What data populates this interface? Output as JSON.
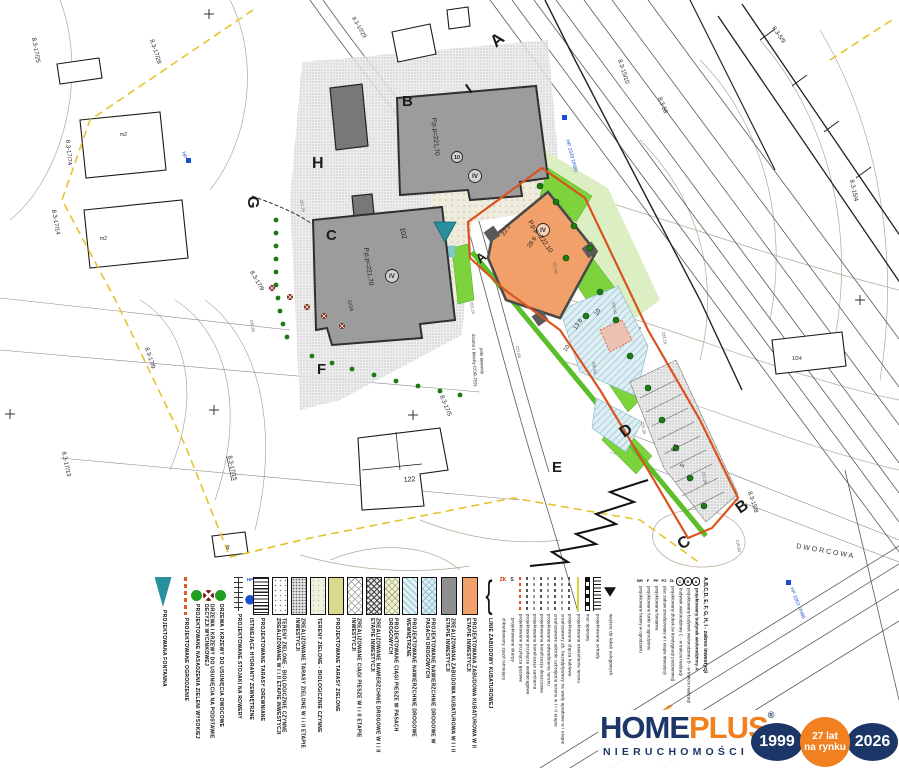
{
  "colors": {
    "boundary_yellow": "#e6c32e",
    "investment_orange": "#d9531e",
    "building_gray": "#9c9c9c",
    "building_orange": "#f0a068",
    "green_bright": "#7cd33c",
    "teal_fountain": "#2a8f9c",
    "logo_navy": "#1c3667",
    "logo_orange": "#f08020",
    "hydrant_blue": "#1b4fd0"
  },
  "legend": {
    "items": [
      {
        "symbol": "sym-fountain",
        "label": "PROJEKTOWANA FONTANNA",
        "x": 155
      },
      {
        "symbol": "sym-fence",
        "label": "PROJEKTOWANE OGRODZENIE",
        "x": 177
      },
      {
        "symbol": "sym-tree-green",
        "label": "PROJEKTOWANE NASADZENIA ZIELENI WYSOKIEJ",
        "x": 188
      },
      {
        "symbol": "sym-tree-remove",
        "label": "DRZEWA I KRZEWY DO USUNIĘCIA NA PODSTAWIE DECYZJI WYCINKOWEJ",
        "x": 200
      },
      {
        "symbol": "sym-tree-fruit",
        "label": "DRZEWA I KRZEWY DO USUNIĘCIA OWOCOWE",
        "x": 212
      },
      {
        "symbol": "sym-bike",
        "label": "PROJEKTOWANE STOJAKI NA ROWERY",
        "x": 230
      },
      {
        "symbol": "sym-hydrant",
        "label": "ISTNIEJĄCE HYDRANTY ZEWNĘTRZNE",
        "x": 242,
        "sym_text": "HP"
      },
      {
        "symbol": "sw sw-stripes",
        "label": "PROJEKTOWANE TARASY DREWNIANE",
        "x": 253
      },
      {
        "symbol": "sw sw-dots-sparse",
        "label": "TERENY ZIELONE - BIOLOGICZNIE CZYNNE ZREALIZOWANE W I i II ETAPIE INWESTYCJI",
        "x": 272
      },
      {
        "symbol": "sw sw-stipple",
        "label": "ZREALIZOWANE TARASY ZIELONE W I i II ETAPIE INWESTYCJI",
        "x": 291
      },
      {
        "symbol": "sw sw-pale-green",
        "label": "TERENY ZIELONE - BIOLOGICZNIE CZYNNE",
        "x": 310
      },
      {
        "symbol": "sw sw-yellow-green",
        "label": "PROJEKTOWANE TARASY ZIELONE",
        "x": 328
      },
      {
        "symbol": "sw sw-diamond-white",
        "label": "ZREALIZOWANE CIĄGI PIESZE W I i II ETAPIE INWESTYCJI",
        "x": 347
      },
      {
        "symbol": "sw sw-diamond-dark",
        "label": "ZREALIZOWANE NAWIERZCHNIE DROGOWE W I i II ETAPIE INWESTYCJI",
        "x": 366
      },
      {
        "symbol": "sw sw-diamond-yellow",
        "label": "PROJEKTOWANE CIĄGI PIESZE W PASACH DROGOWYCH",
        "x": 384
      },
      {
        "symbol": "sw sw-hatch-blue",
        "label": "PROJEKTOWANE NAWIERZCHNIE DROGOWE WEWNĘTRZNE",
        "x": 402
      },
      {
        "symbol": "sw sw-diamond-blue",
        "label": "PROJEKTOWANE NAWIERZCHNIE DROGOWE W PASACH DROGOWYCH",
        "x": 421
      },
      {
        "symbol": "sw sw-gray",
        "label": "ZREALIZOWANA ZABUDOWA KUBATUROWA W I i II ETAPIE INWESTYCJI",
        "x": 441
      },
      {
        "symbol": "sw sw-orange",
        "label": "PROJEKTOWANA ZABUDOWA KUBATUROWA W II ETAPIE INWESTYCJI",
        "x": 462
      },
      {
        "symbol": "sym-bracket",
        "label": "LINIE ZABUDOWY KUBATUROWEJ",
        "x": 481,
        "sym_text": "{",
        "bold": true
      },
      {
        "symbol": "sym-text red",
        "label": "zlikwidowany zjazd istniejący",
        "x": 497,
        "sym_text": "ZK",
        "small": true
      },
      {
        "symbol": "sym-text",
        "label": "projektowane skarpy",
        "x": 506,
        "sym_text": "S",
        "small": true
      },
      {
        "symbol": "sym-dash c-orange",
        "label": "projektowane przyłącza gazowe",
        "x": 514,
        "small": true
      },
      {
        "symbol": "sym-dash",
        "label": "projektowane przyłącze wodociągowe",
        "x": 521,
        "small": true
      },
      {
        "symbol": "sym-dash c-gray",
        "label": "projektowana kanalizacja sanitarna",
        "x": 528,
        "small": true
      },
      {
        "symbol": "sym-dash",
        "label": "projektowana kanalizacja deszczowa",
        "x": 535,
        "small": true
      },
      {
        "symbol": "sym-dash c-gray",
        "label": "projektowane odwodnienie terenu",
        "x": 542,
        "small": true
      },
      {
        "symbol": "sym-dash",
        "label": "zrealizowane odcinki uzbrojenia terenu w I i II etapie",
        "x": 549,
        "small": true
      },
      {
        "symbol": "sym-dash c-gray",
        "label": "zrealizowany zb. bezodpływowy na wody opadowe w I etapie",
        "x": 556,
        "small": true
      },
      {
        "symbol": "sym-dash",
        "label": "projektowane złącza kablowe",
        "x": 563,
        "small": true
      },
      {
        "symbol": "line-yellow",
        "label": "projektowane oświetlenie terenu",
        "x": 572,
        "small": true
      },
      {
        "symbol": "sym-scalebar",
        "label": "mur oporowy",
        "x": 581,
        "small": true
      },
      {
        "symbol": "sym-ruler",
        "label": "projektowane schody",
        "x": 591,
        "small": true
      },
      {
        "symbol": "sym-tri",
        "label": "wejście do lokali usługowych",
        "x": 604,
        "small": true
      }
    ]
  },
  "ab_block": {
    "heading": "A,B,C,D, E, F, G, H, I - zakres inwestycji",
    "rows": [
      {
        "sym": "A",
        "circ": true,
        "label": "projektowany budynek wielorodzinny A",
        "bold": true
      },
      {
        "sym": "B",
        "circ": true,
        "label": "projektowany budynek wielorodzinny B - w trakcie realizacji"
      },
      {
        "sym": "C",
        "circ": true,
        "label": "budynek wielorodzinny C - w trakcie realizacji"
      },
      {
        "sym": "ŻŁ",
        "label": "projektowany żłobek (w kondygnacji podziemnej)"
      },
      {
        "sym": "PZ",
        "label": "plac zabaw zrealizowany w I etapie inwestycji"
      },
      {
        "sym": "PF",
        "label": "projektowana fontanna"
      },
      {
        "sym": "F",
        "label": "projektowane furtki w ogrodzeniu"
      },
      {
        "sym": "BR",
        "label": "projektowane bramy w ogrodzeniu"
      }
    ]
  },
  "map": {
    "labels": [
      {
        "t": "8.3-17/25",
        "x": 32,
        "y": 38,
        "r": 80,
        "s": 6
      },
      {
        "t": "8.3-17/28",
        "x": 150,
        "y": 40,
        "r": 72,
        "s": 6
      },
      {
        "t": "8.3-1/229",
        "x": 352,
        "y": 18,
        "r": 60,
        "s": 5.5
      },
      {
        "t": "8.3-17/74",
        "x": 66,
        "y": 140,
        "r": 85,
        "s": 6
      },
      {
        "t": "8.3-17/14",
        "x": 52,
        "y": 210,
        "r": 80,
        "s": 6
      },
      {
        "t": "8.3-17/9",
        "x": 250,
        "y": 272,
        "r": 60,
        "s": 6
      },
      {
        "t": "8.3-17/9",
        "x": 145,
        "y": 348,
        "r": 72,
        "s": 6
      },
      {
        "t": "8.3-17/13",
        "x": 62,
        "y": 452,
        "r": 78,
        "s": 6
      },
      {
        "t": "8.3-17/15",
        "x": 228,
        "y": 456,
        "r": 78,
        "s": 6,
        "u": true
      },
      {
        "t": "8.3-17/5",
        "x": 440,
        "y": 396,
        "r": 68,
        "s": 6
      },
      {
        "t": "8.3-15/10",
        "x": 618,
        "y": 60,
        "r": 72,
        "s": 6
      },
      {
        "t": "8.3-58",
        "x": 658,
        "y": 98,
        "r": 68,
        "s": 6
      },
      {
        "t": "8.3-5/9",
        "x": 772,
        "y": 28,
        "r": 55,
        "s": 6
      },
      {
        "t": "8.3-15/4",
        "x": 850,
        "y": 180,
        "r": 78,
        "s": 6
      },
      {
        "t": "8.3-15/8",
        "x": 748,
        "y": 492,
        "r": 72,
        "s": 6
      },
      {
        "t": "1/24",
        "x": 792,
        "y": 360,
        "r": 0,
        "s": 5
      },
      {
        "t": "HP 2329 DN80",
        "x": 566,
        "y": 140,
        "r": 75,
        "s": 5,
        "c": "#2255cc"
      },
      {
        "t": "HP 1003 DN80",
        "x": 790,
        "y": 588,
        "r": 68,
        "s": 5,
        "c": "#2255cc"
      },
      {
        "t": "HP",
        "x": 182,
        "y": 152,
        "r": 75,
        "s": 5,
        "c": "#2255cc"
      },
      {
        "t": "DWORCOWA",
        "x": 796,
        "y": 548,
        "r": 10,
        "s": 7,
        "c": "#333",
        "sp": 2
      },
      {
        "t": "ściana z blachy COR-TEN",
        "x": 472,
        "y": 334,
        "r": 88,
        "s": 4.5
      },
      {
        "t": "pole lawendy",
        "x": 480,
        "y": 348,
        "r": 88,
        "s": 4.5
      },
      {
        "t": "102",
        "x": 400,
        "y": 228,
        "r": 78,
        "s": 7
      },
      {
        "t": "122",
        "x": 404,
        "y": 482,
        "r": -5,
        "s": 7
      },
      {
        "t": "122A",
        "x": 348,
        "y": 300,
        "r": 80,
        "s": 5
      },
      {
        "t": "g",
        "x": 226,
        "y": 548,
        "r": 10,
        "s": 6
      },
      {
        "t": "m2",
        "x": 120,
        "y": 136,
        "r": 0,
        "s": 5
      },
      {
        "t": "m2",
        "x": 100,
        "y": 240,
        "r": 0,
        "s": 5
      },
      {
        "t": "28.6",
        "x": 530,
        "y": 248,
        "r": -55,
        "s": 6
      },
      {
        "t": "22.2",
        "x": 504,
        "y": 236,
        "r": -55,
        "s": 6
      },
      {
        "t": "13.6",
        "x": 576,
        "y": 330,
        "r": -55,
        "s": 6
      },
      {
        "t": "10",
        "x": 597,
        "y": 316,
        "r": -55,
        "s": 6
      },
      {
        "t": "10",
        "x": 566,
        "y": 352,
        "r": -55,
        "s": 6
      },
      {
        "t": "6.1",
        "x": 674,
        "y": 452,
        "r": -58,
        "s": 6
      },
      {
        "t": "5",
        "x": 683,
        "y": 468,
        "r": -58,
        "s": 6
      },
      {
        "t": "B",
        "x": 402,
        "y": 106,
        "r": 0,
        "s": 15,
        "b": true
      },
      {
        "t": "C",
        "x": 326,
        "y": 240,
        "r": 0,
        "s": 15,
        "b": true
      },
      {
        "t": "A",
        "x": 480,
        "y": 264,
        "r": -38,
        "s": 13,
        "b": true
      },
      {
        "t": "P.p.p=221,70",
        "x": 432,
        "y": 118,
        "r": 85,
        "s": 6.5
      },
      {
        "t": "P.p.p=221,70",
        "x": 364,
        "y": 248,
        "r": 82,
        "s": 6.5
      },
      {
        "t": "P.p.p=222,10",
        "x": 528,
        "y": 222,
        "r": 55,
        "s": 6.5
      },
      {
        "t": "IV",
        "x": 475,
        "y": 178,
        "r": 0,
        "s": 6,
        "b": true,
        "a": "m"
      },
      {
        "t": "IV",
        "x": 392,
        "y": 278,
        "r": 0,
        "s": 6,
        "b": true,
        "a": "m"
      },
      {
        "t": "IV",
        "x": 543,
        "y": 232,
        "r": 0,
        "s": 6,
        "b": true,
        "a": "m"
      },
      {
        "t": "10",
        "x": 457,
        "y": 159,
        "r": 0,
        "s": 5.5,
        "b": true,
        "a": "m"
      },
      {
        "t": "222.10",
        "x": 470,
        "y": 302,
        "r": 80,
        "s": 4,
        "c": "#555"
      },
      {
        "t": "221.88",
        "x": 516,
        "y": 346,
        "r": 80,
        "s": 4,
        "c": "#555"
      },
      {
        "t": "220.44",
        "x": 592,
        "y": 362,
        "r": 80,
        "s": 4,
        "c": "#555"
      },
      {
        "t": "222.35",
        "x": 641,
        "y": 422,
        "r": 80,
        "s": 4,
        "c": "#555"
      },
      {
        "t": "221.95",
        "x": 702,
        "y": 472,
        "r": 80,
        "s": 4,
        "c": "#555"
      },
      {
        "t": "223.15",
        "x": 662,
        "y": 332,
        "r": 80,
        "s": 4,
        "c": "#555"
      },
      {
        "t": "220.90",
        "x": 612,
        "y": 302,
        "r": 80,
        "s": 4,
        "c": "#555"
      },
      {
        "t": "221.40",
        "x": 553,
        "y": 262,
        "r": 80,
        "s": 4,
        "c": "#555"
      },
      {
        "t": "219.80",
        "x": 736,
        "y": 540,
        "r": 80,
        "s": 4,
        "c": "#555"
      },
      {
        "t": "221.70",
        "x": 300,
        "y": 200,
        "r": 80,
        "s": 4,
        "c": "#555"
      },
      {
        "t": "220.30",
        "x": 250,
        "y": 320,
        "r": 80,
        "s": 4,
        "c": "#555"
      }
    ],
    "letters": [
      {
        "t": "A",
        "x": 496,
        "y": 48,
        "r": -40,
        "s": 17,
        "b": true,
        "n": "boundary-letter"
      },
      {
        "t": "B",
        "x": 740,
        "y": 514,
        "r": -35,
        "s": 16,
        "b": true,
        "n": "boundary-letter"
      },
      {
        "t": "C",
        "x": 682,
        "y": 550,
        "r": -35,
        "s": 16,
        "b": true,
        "n": "boundary-letter"
      },
      {
        "t": "D",
        "x": 624,
        "y": 438,
        "r": -35,
        "s": 16,
        "b": true,
        "n": "boundary-letter"
      },
      {
        "t": "E",
        "x": 552,
        "y": 472,
        "r": 0,
        "s": 15,
        "b": true,
        "n": "boundary-letter"
      },
      {
        "t": "F",
        "x": 317,
        "y": 374,
        "r": 0,
        "s": 15,
        "b": true,
        "n": "boundary-letter"
      },
      {
        "t": "G",
        "x": 248,
        "y": 196,
        "r": 90,
        "s": 16,
        "b": true,
        "n": "boundary-letter"
      },
      {
        "t": "H",
        "x": 312,
        "y": 168,
        "r": 0,
        "s": 16,
        "b": true,
        "n": "boundary-letter"
      },
      {
        "t": "I",
        "x": 470,
        "y": 94,
        "r": -35,
        "s": 15,
        "b": true,
        "n": "boundary-letter"
      }
    ]
  },
  "logo": {
    "brand_home": "HOME",
    "brand_plus": "PLUS",
    "accent": "´",
    "registered": "®",
    "subtitle": "NIERUCHOMOŚCI",
    "badge_start": "1999",
    "badge_mid_line1": "27 lat",
    "badge_mid_line2": "na rynku",
    "badge_end": "2026"
  }
}
